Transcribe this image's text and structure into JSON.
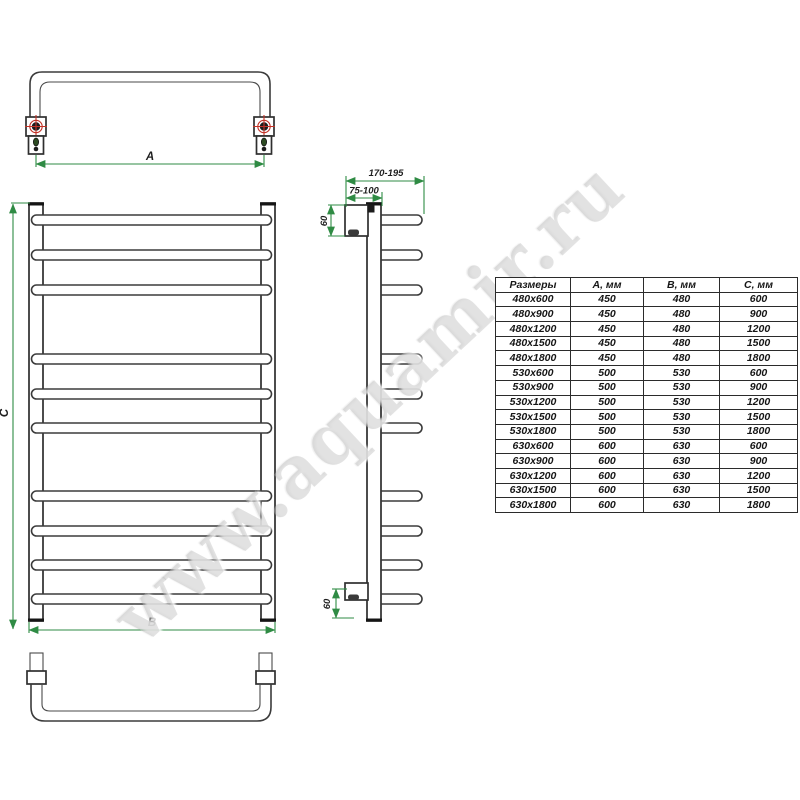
{
  "watermark": {
    "text": "www.aquamir.ru"
  },
  "colors": {
    "dimension_green": "#2f8b44",
    "line_dark": "#3b3b3b",
    "marker_red": "#c23227"
  },
  "drawing": {
    "top_view": {
      "width_label": "A"
    },
    "front_view": {
      "width_label": "B",
      "height_label": "C"
    },
    "side_view": {
      "total_depth": "170-195",
      "bracket_offset": "75-100",
      "top_bracket_size": "60",
      "bottom_bracket_size": "60"
    }
  },
  "table": {
    "headers": [
      "Размеры",
      "А, мм",
      "В, мм",
      "С, мм"
    ],
    "rows": [
      [
        "480x600",
        "450",
        "480",
        "600"
      ],
      [
        "480x900",
        "450",
        "480",
        "900"
      ],
      [
        "480x1200",
        "450",
        "480",
        "1200"
      ],
      [
        "480x1500",
        "450",
        "480",
        "1500"
      ],
      [
        "480x1800",
        "450",
        "480",
        "1800"
      ],
      [
        "530x600",
        "500",
        "530",
        "600"
      ],
      [
        "530x900",
        "500",
        "530",
        "900"
      ],
      [
        "530x1200",
        "500",
        "530",
        "1200"
      ],
      [
        "530x1500",
        "500",
        "530",
        "1500"
      ],
      [
        "530x1800",
        "500",
        "530",
        "1800"
      ],
      [
        "630x600",
        "600",
        "630",
        "600"
      ],
      [
        "630x900",
        "600",
        "630",
        "900"
      ],
      [
        "630x1200",
        "600",
        "630",
        "1200"
      ],
      [
        "630x1500",
        "600",
        "630",
        "1500"
      ],
      [
        "630x1800",
        "600",
        "630",
        "1800"
      ]
    ]
  }
}
